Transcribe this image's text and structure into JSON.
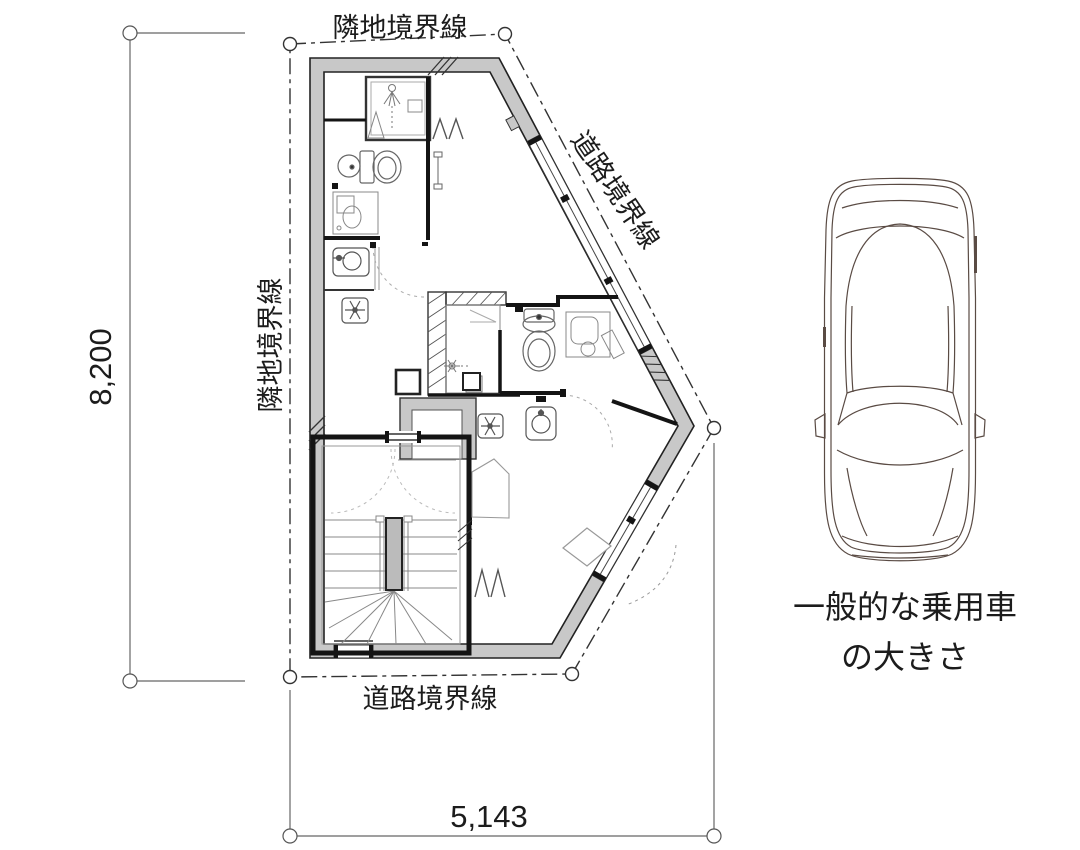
{
  "drawing": {
    "boundary_labels": {
      "top": "隣地境界線",
      "left": "隣地境界線",
      "road_upper": "道路境界線",
      "road_lower": "道路境界線"
    },
    "dimensions": {
      "height": "8,200",
      "width": "5,143"
    },
    "car_caption": {
      "line1": "一般的な乗用車",
      "line2": "の大きさ"
    },
    "colors": {
      "wall_fill": "#c8c8c8",
      "boundary_line": "#333333",
      "bold_wall": "#141414",
      "fixture_line": "#777777",
      "car_line": "#5a4b44",
      "text": "#1c1c1c"
    }
  }
}
